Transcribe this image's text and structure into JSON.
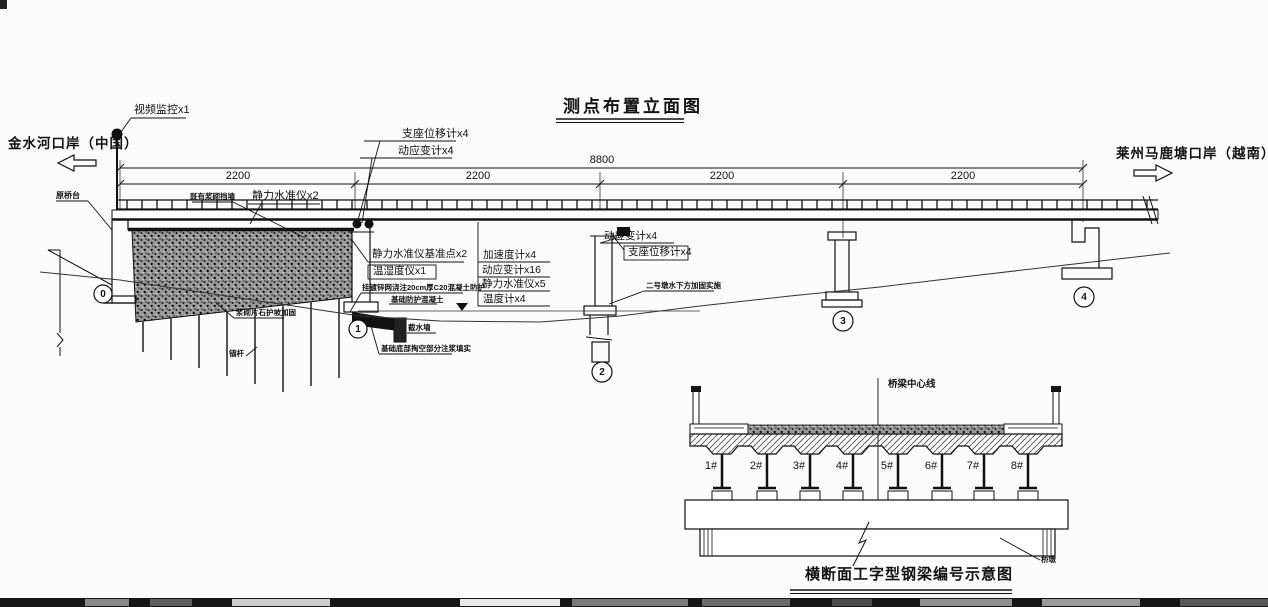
{
  "title": "测点布置立面图",
  "elevation": {
    "left_bank": "金水河口岸（中国）",
    "right_bank": "莱州马鹿塘口岸（越南）",
    "camera": "视频监控x1",
    "dim_total": "8800",
    "dim_spans": [
      "2200",
      "2200",
      "2200",
      "2200"
    ],
    "pier_nums": [
      "0",
      "1",
      "2",
      "3",
      "4"
    ],
    "labels": {
      "bearing_disp_p1": "支座位移计x4",
      "dyn_strain_p1": "动应变计x4",
      "static_level_2": "静力水准仪x2",
      "embank_note": "既有浆砌挡墙",
      "old_abutment": "原桥台",
      "benchmark": "静力水准仪基准点x2",
      "temp_humidity": "温湿度仪x1",
      "mesh_concrete": "挂镀锌网浇注20cm厚C20混凝土防护",
      "foundation_concrete": "基础防护混凝土",
      "accelerometer": "加速度计x4",
      "dyn_strain_16": "动应变计x16",
      "static_level_5": "静力水准仪x5",
      "thermometer": "温度计x4",
      "dyn_strain_p2": "动应变计x4",
      "bearing_disp_p2": "支座位移计x4",
      "pier2_note": "二号墩水下方加固实施",
      "cutoff_wall": "截水墙",
      "grouting_note": "基础底部掏空部分注浆填实",
      "slope_note": "浆砌片石护坡加固",
      "anchor": "锚杆"
    }
  },
  "cross_section": {
    "caption": "横断面工字型钢梁编号示意图",
    "centerline": "桥梁中心线",
    "pier": "桥墩",
    "beams": [
      "1#",
      "2#",
      "3#",
      "4#",
      "5#",
      "6#",
      "7#",
      "8#"
    ]
  }
}
